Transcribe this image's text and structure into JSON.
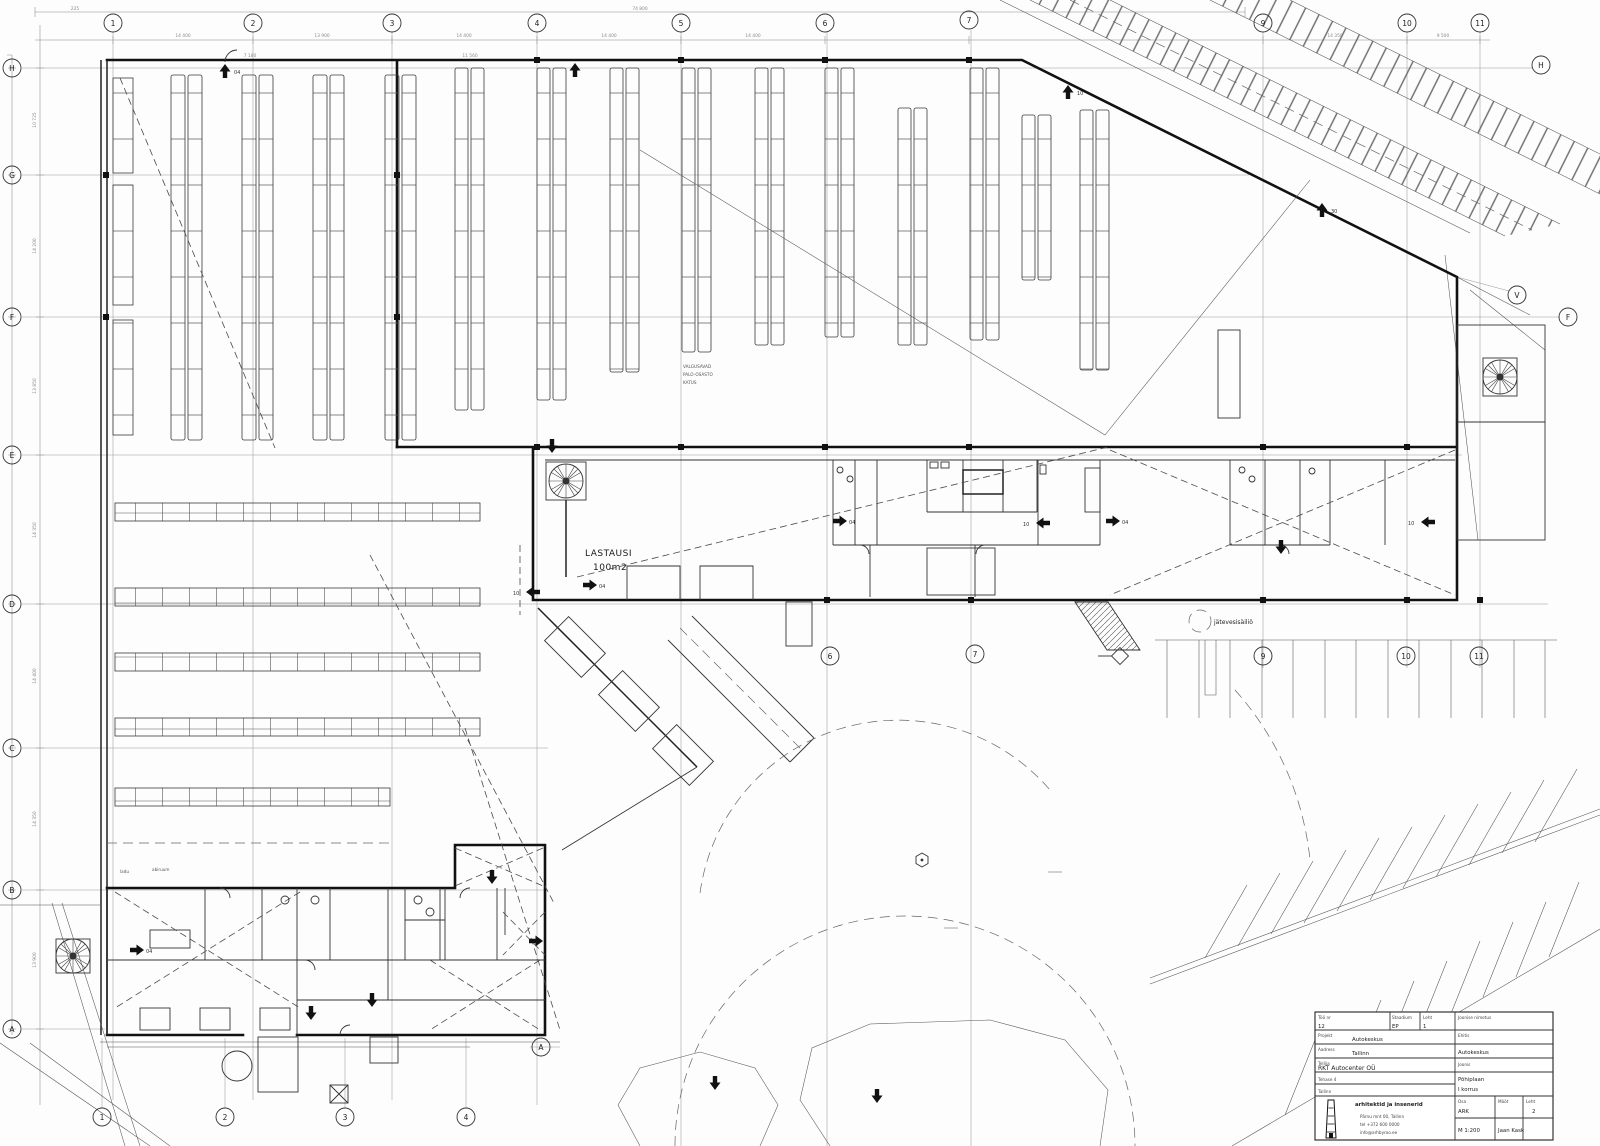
{
  "grid": {
    "top": [
      "1",
      "2",
      "3",
      "4",
      "5",
      "6",
      "7",
      "9",
      "10",
      "11"
    ],
    "left": [
      "H",
      "G",
      "F",
      "E",
      "D",
      "C",
      "B",
      "A"
    ],
    "right": [
      "H",
      "V",
      "F"
    ],
    "bottom": [
      "1",
      "2",
      "3",
      "4"
    ],
    "wing": [
      "6",
      "7",
      "9",
      "10",
      "11"
    ],
    "lowerA": "A"
  },
  "labels": {
    "lastaus1": "LASTAUSI",
    "lastaus2": "100m2",
    "tank": "jätevesisäiliö",
    "note1": "VALGUSAVAD",
    "note2": "PALO-OSASTO",
    "note3": "KATUS",
    "room1": "ladu",
    "room2": "abiruum"
  },
  "markers": {
    "m04": "04",
    "m10": "10",
    "m30": "30"
  },
  "dims": {
    "total": "74 800",
    "c1": "225",
    "t1": "14 400",
    "t2": "13 900",
    "t3": "14 400",
    "t4": "14 400",
    "t5": "14 400",
    "t6": "14 350",
    "t7": "9 500",
    "l1": "10 725",
    "l2": "14 200",
    "l3": "13 850",
    "l4": "14 350",
    "l5": "14 400",
    "l6": "14 350",
    "l7": "13 900",
    "m1": "11 560",
    "m2": "7 180"
  },
  "titleblock": {
    "wno_l": "Töö nr",
    "wno": "12",
    "st_l": "Staadium",
    "st": "EP",
    "sh_l": "Leht",
    "sh": "1",
    "proj_l": "Projekt",
    "proj": "Autokeskus",
    "addr_l": "Aadress",
    "addr": "Tallinn",
    "cl_l": "Tellija",
    "cl": "RKT Autocenter OÜ",
    "cl2": "Tehase 4",
    "cl3": "Tallinn",
    "firm": "arhitektid ja insenerid",
    "f1": "Pärnu mnt 00, Tallinn",
    "f2": "tel +372 600 0000",
    "f3": "info@arhbyroo.ee",
    "nm_l": "Joonise nimetus",
    "eh_l": "Ehitis",
    "eh": "Autokeskus",
    "jn_l": "Joonis",
    "jn1": "Põhiplaan",
    "jn2": "I korrus",
    "osa_l": "Osa",
    "osa": "ARK",
    "moot_l": "Mõõt",
    "leht_l": "Leht",
    "leht": "2",
    "scale": "M 1:200",
    "author": "Jaan Kask"
  }
}
